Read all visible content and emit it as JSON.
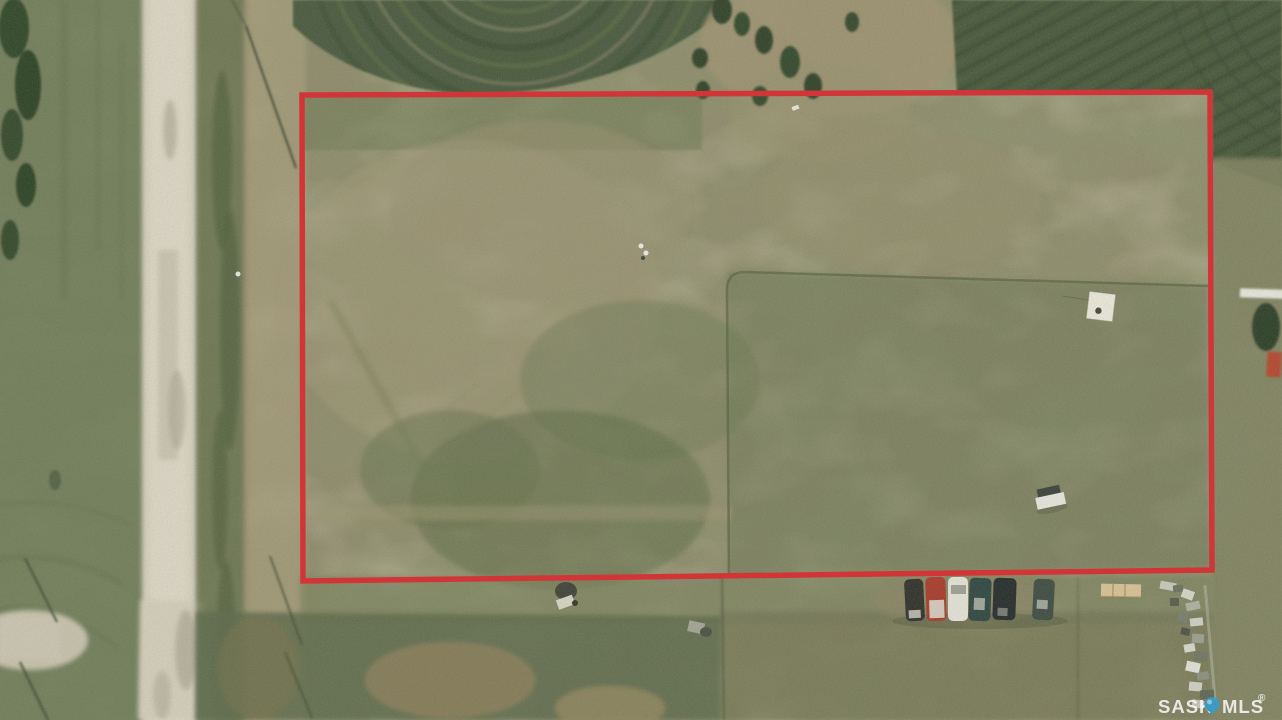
{
  "watermark": {
    "brand_prefix": "SASK",
    "brand_suffix": "MLS",
    "registered_mark": "®",
    "text_color": "#ffffff",
    "pin_color": "#2f9fd6"
  },
  "annotation": {
    "boundary_color": "#d23538",
    "boundary_points": "302,95 1210,92 1212,570 303,581",
    "boundary_stroke_width": "5.5"
  },
  "scene": {
    "car_colors": [
      "#2e2e2a",
      "#a8392b",
      "#e6e4da",
      "#2c4540",
      "#23292b",
      "#3c4a42"
    ]
  }
}
